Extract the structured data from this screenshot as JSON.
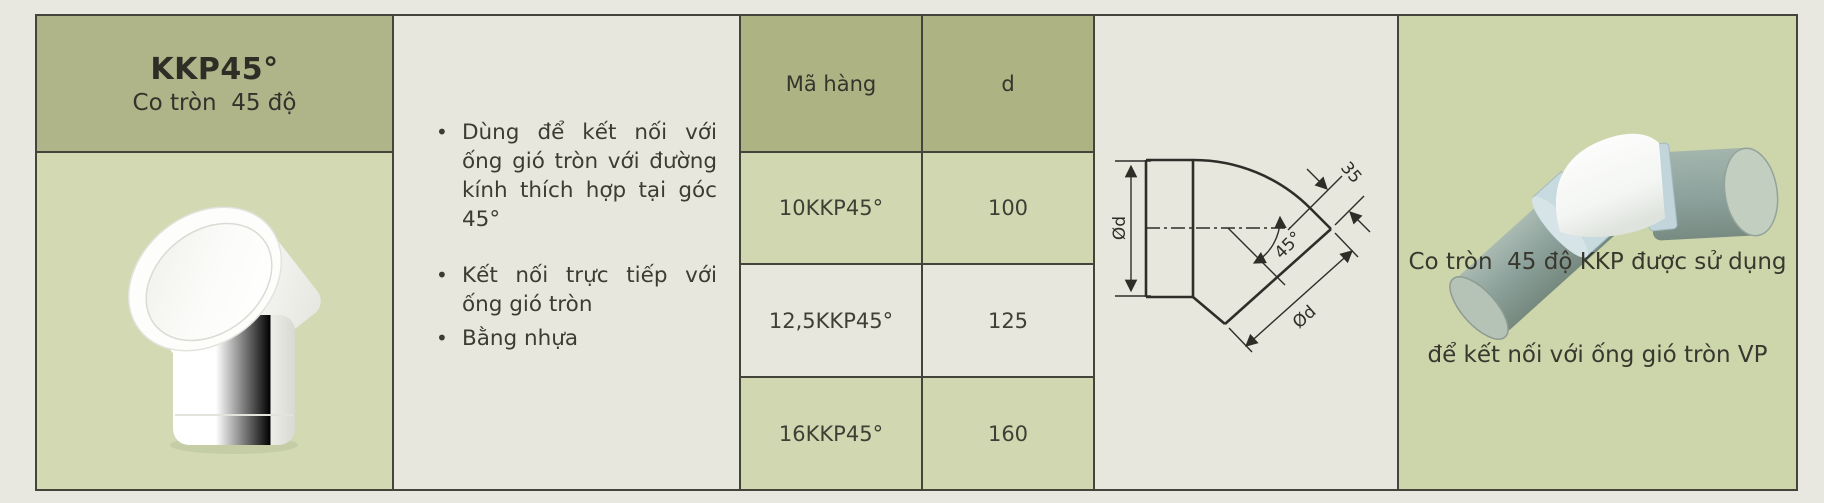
{
  "header": {
    "code": "KKP45°",
    "name": "Co tròn  45 độ"
  },
  "description": {
    "bullets": [
      "Dùng để kết nối với ống gió tròn với đường kính thích hợp tại góc 45°",
      "Kết nối trực tiếp với ống gió tròn",
      "Bằng nhựa"
    ]
  },
  "spec_table": {
    "col_code": "Mã hàng",
    "col_d": "d",
    "rows": [
      {
        "code": "10KKP45°",
        "d": "100"
      },
      {
        "code": "12,5KKP45°",
        "d": "125"
      },
      {
        "code": "16KKP45°",
        "d": "160"
      }
    ]
  },
  "drawing": {
    "dia_inlet": "Ød",
    "collar_length": "35",
    "angle": "45°",
    "dia_outlet": "Ød"
  },
  "usage": {
    "line1": "Co tròn  45 độ KKP được sử dụng",
    "line2": "để kết nối với ống gió tròn VP"
  },
  "colors": {
    "olive_header": "#afb589",
    "light_green_cell": "#d1d8b1",
    "cream_cell": "#e8e7de",
    "usage_panel_green": "#cdd5ab",
    "border": "#44443b",
    "text": "#3c3c32"
  }
}
